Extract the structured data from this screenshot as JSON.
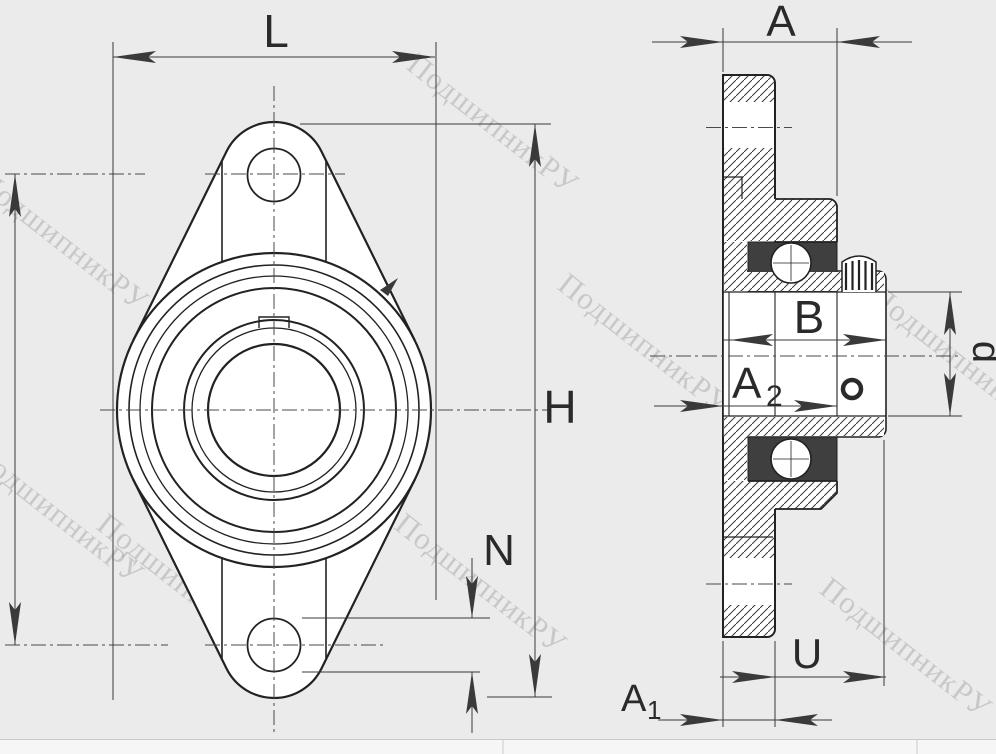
{
  "drawing_type": "bearing-unit-technical-drawing",
  "watermark": {
    "text": "ПодшипникРУ"
  },
  "labels": {
    "width": "L",
    "flange_width": "A",
    "height": "H",
    "bolt_hole_diameter": "N",
    "inner_ring_width": "B",
    "a2_base": "A",
    "a2_sub": "2",
    "a1_base": "A",
    "a1_sub": "1",
    "protrusion": "U",
    "bore_diameter": "d"
  },
  "colors": {
    "background": "#ebebeb",
    "line": "#222222",
    "dim_line": "#3a3a3a",
    "watermark": "rgba(0,0,0,0.15)",
    "dark_fill": "#3f3f3f",
    "footer_background": "#f6f6f6",
    "footer_line": "#c9c9c9"
  }
}
